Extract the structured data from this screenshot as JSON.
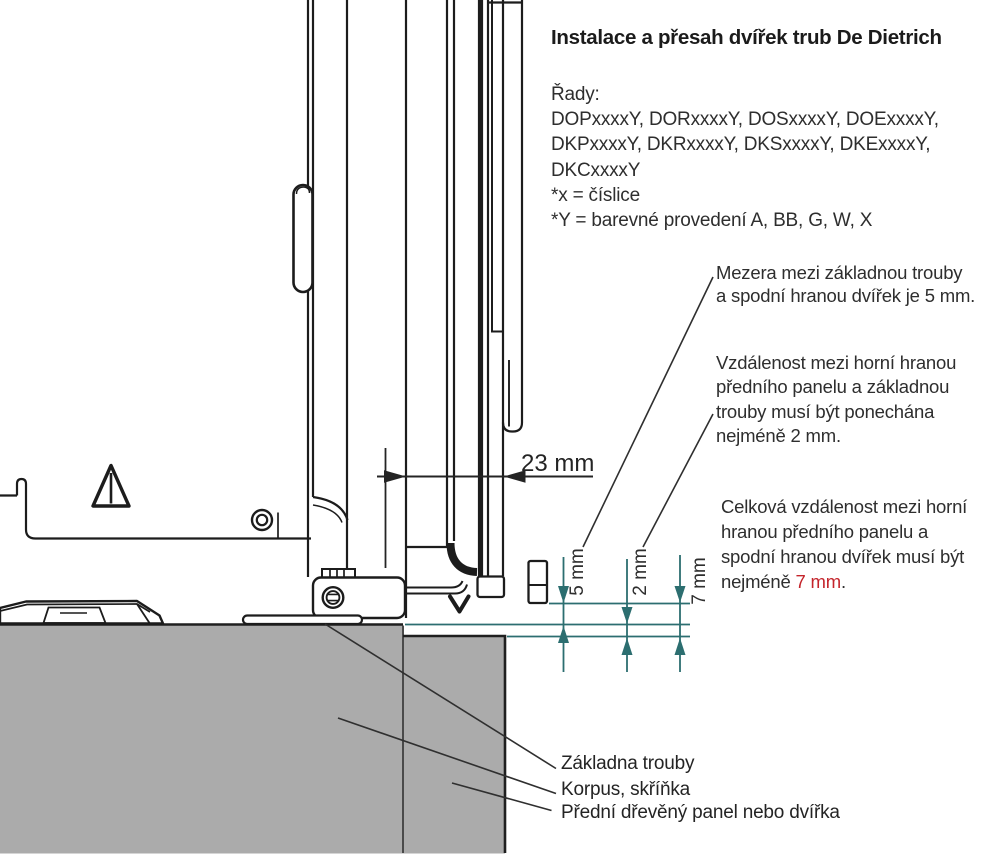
{
  "header": {
    "title": "Instalace a přesah dvířek trub De Dietrich",
    "series_heading": "Řady:",
    "series_lines": [
      "DOPxxxxY, DORxxxxY, DOSxxxxY, DOExxxxY,",
      "DKPxxxxY, DKRxxxxY, DKSxxxxY, DKExxxxY,",
      "DKCxxxxY",
      "*x = číslice",
      "*Y = barevné provedení A, BB, G, W, X"
    ]
  },
  "annotations": {
    "gap_door_base": {
      "lines": [
        "Mezera mezi základnou trouby",
        "a spodní hranou dvířek je 5 mm."
      ]
    },
    "gap_panel_base": {
      "lines": [
        "Vzdálenost mezi horní hranou",
        "předního panelu a základnou",
        "trouby musí být ponechána",
        "nejméně 2 mm."
      ]
    },
    "gap_total": {
      "lines": [
        "Celková vzdálenost mezi horní",
        "hranou předního panelu a",
        "spodní hranou dvířek musí být"
      ],
      "last_line_prefix": "nejméně ",
      "last_line_value": "7 mm",
      "last_line_suffix": "."
    }
  },
  "dimensions": {
    "door_overhang": "23 mm",
    "gap_door_base": "5 mm",
    "gap_panel_base": "2 mm",
    "gap_total": "7 mm"
  },
  "part_labels": {
    "oven_base": "Základna trouby",
    "cabinet": "Korpus, skříňka",
    "front_panel": "Přední dřevěný panel nebo dvířka"
  },
  "colors": {
    "accent_red": "#c4242b",
    "dimension_teal": "#2c6e70",
    "cabinet_gray": "#ababab",
    "line_black": "#1c1c1c"
  }
}
